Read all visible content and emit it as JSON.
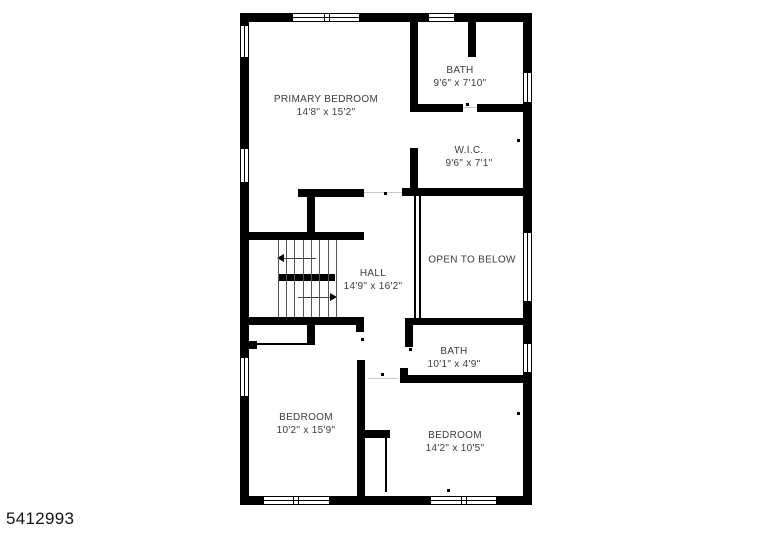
{
  "footer": {
    "listing_id": "5412993"
  },
  "colors": {
    "wall": "#000000",
    "text": "#3c3c3c",
    "background": "#ffffff",
    "tread": "#555555",
    "threshold": "#c9c9c9"
  },
  "icons": {
    "stair_arrow_up": "triangle-left",
    "stair_arrow_down": "triangle-right"
  },
  "rooms": {
    "primary_bedroom": {
      "name": "PRIMARY BEDROOM",
      "dims": "14'8\" x 15'2\""
    },
    "bath_upper": {
      "name": "BATH",
      "dims": "9'6\" x 7'10\""
    },
    "wic": {
      "name": "W.I.C.",
      "dims": "9'6\" x 7'1\""
    },
    "open_to_below": {
      "name": "OPEN TO BELOW",
      "dims": ""
    },
    "hall": {
      "name": "HALL",
      "dims": "14'9\" x 16'2\""
    },
    "bath_lower": {
      "name": "BATH",
      "dims": "10'1\" x 4'9\""
    },
    "bedroom_left": {
      "name": "BEDROOM",
      "dims": "10'2\" x 15'9\""
    },
    "bedroom_right": {
      "name": "BEDROOM",
      "dims": "14'2\" x 10'5\""
    }
  }
}
